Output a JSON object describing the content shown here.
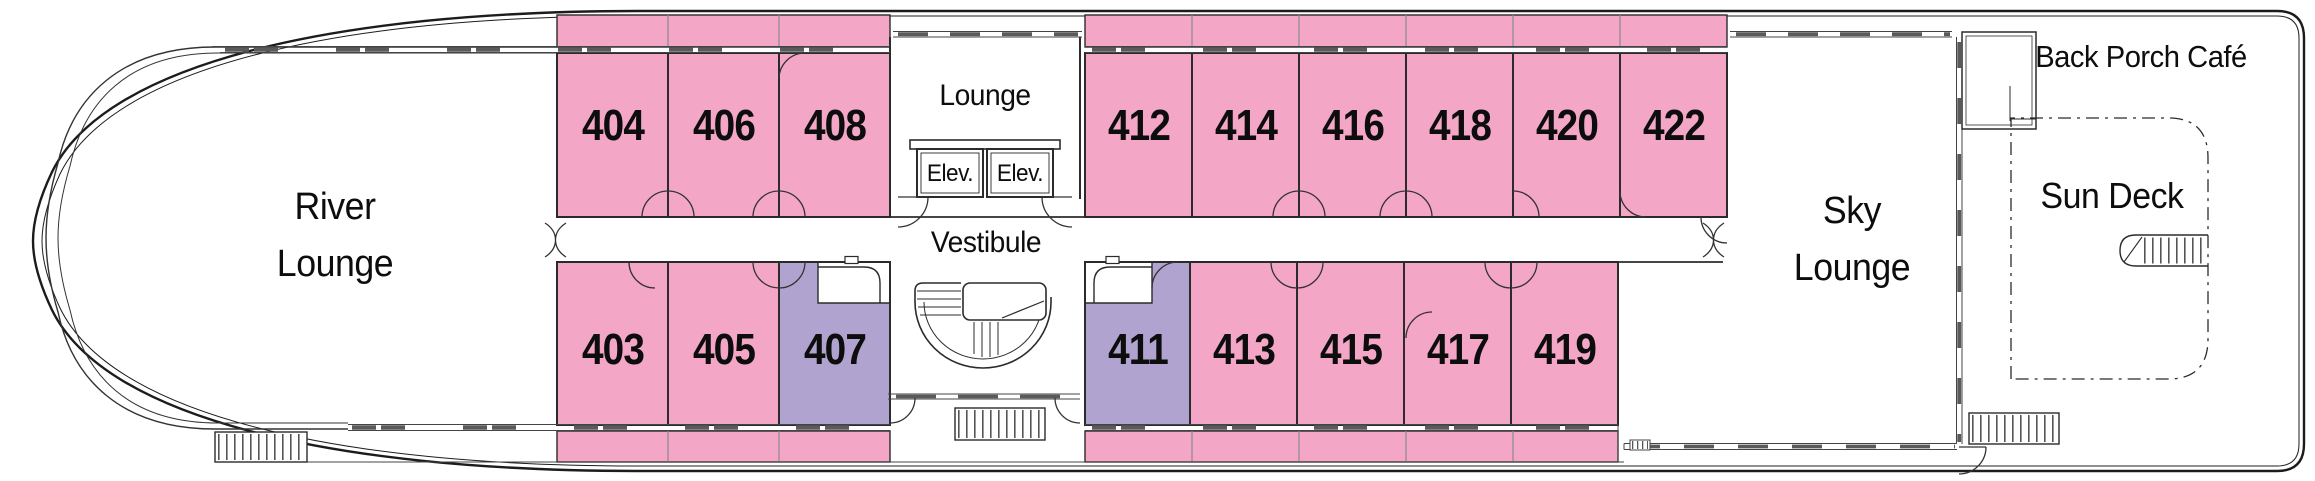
{
  "plan_title": "Deck plan",
  "labels": {
    "river_lounge": {
      "line1": "River",
      "line2": "Lounge"
    },
    "lounge": "Lounge",
    "elevator1": "Elev.",
    "elevator2": "Elev.",
    "vestibule": "Vestibule",
    "sky_lounge": {
      "line1": "Sky",
      "line2": "Lounge"
    },
    "sun_deck": "Sun Deck",
    "back_porch_cafe": "Back Porch Café"
  },
  "cabins": {
    "top_row": [
      {
        "number": "404",
        "color": "pink"
      },
      {
        "number": "406",
        "color": "pink"
      },
      {
        "number": "408",
        "color": "pink"
      },
      {
        "number": "412",
        "color": "pink"
      },
      {
        "number": "414",
        "color": "pink"
      },
      {
        "number": "416",
        "color": "pink"
      },
      {
        "number": "418",
        "color": "pink"
      },
      {
        "number": "420",
        "color": "pink"
      },
      {
        "number": "422",
        "color": "pink"
      }
    ],
    "bottom_row": [
      {
        "number": "403",
        "color": "pink"
      },
      {
        "number": "405",
        "color": "pink"
      },
      {
        "number": "407",
        "color": "purple"
      },
      {
        "number": "411",
        "color": "purple"
      },
      {
        "number": "413",
        "color": "pink"
      },
      {
        "number": "415",
        "color": "pink"
      },
      {
        "number": "417",
        "color": "pink"
      },
      {
        "number": "419",
        "color": "pink"
      }
    ]
  },
  "colors": {
    "cabin_pink": "#f4a6c7",
    "cabin_purple": "#b1a3cf",
    "wall": "#2b2b2b"
  }
}
